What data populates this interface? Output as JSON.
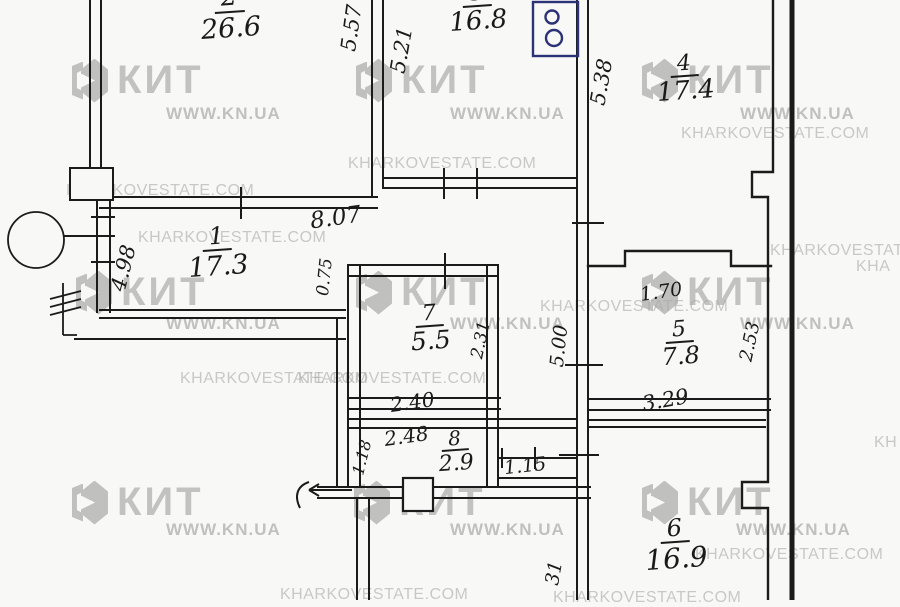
{
  "rooms": {
    "r1": {
      "number": "1",
      "area": "17.3"
    },
    "r2": {
      "number": "2",
      "area": "26.6"
    },
    "r3": {
      "number": "3",
      "area": "16.8"
    },
    "r4": {
      "number": "4",
      "area": "17.4"
    },
    "r5": {
      "number": "5",
      "area": "7.8"
    },
    "r6": {
      "number": "6",
      "area": "16.9"
    },
    "r7": {
      "number": "7",
      "area": "5.5"
    },
    "r8": {
      "number": "8",
      "area": "2.9"
    }
  },
  "dims": {
    "v557": "5.57",
    "v521": "5.21",
    "v538": "5.38",
    "h807": "8.07",
    "v498": "4.98",
    "v075": "0.75",
    "v231": "2.31",
    "v500": "5.00",
    "h240": "2.40",
    "h248": "2.48",
    "v118": "1.18",
    "h115": "1.15",
    "h170": "1.70",
    "v253": "2.53",
    "h329": "3.29",
    "v31": "31"
  },
  "watermarks": {
    "brand": "КИТ",
    "site": "WWW.KN.UA",
    "estate": "KHARKOVESTATE.COM",
    "estate_cut_a": "KHARKOVESTAT",
    "estate_cut_b": "KHA",
    "estate_cut_c": "KH"
  },
  "icons": {
    "stove": "stove-icon",
    "column": "round-column-icon",
    "entrance": "entrance-arrow-icon",
    "section": "section-hatch-icon",
    "shaft": "shaft-box-icon"
  },
  "colors": {
    "ink": "#1b1b1b",
    "stove_ink": "#2b3277",
    "watermark_gray": "#8d8d8d",
    "paper": "#f8f8f6"
  }
}
